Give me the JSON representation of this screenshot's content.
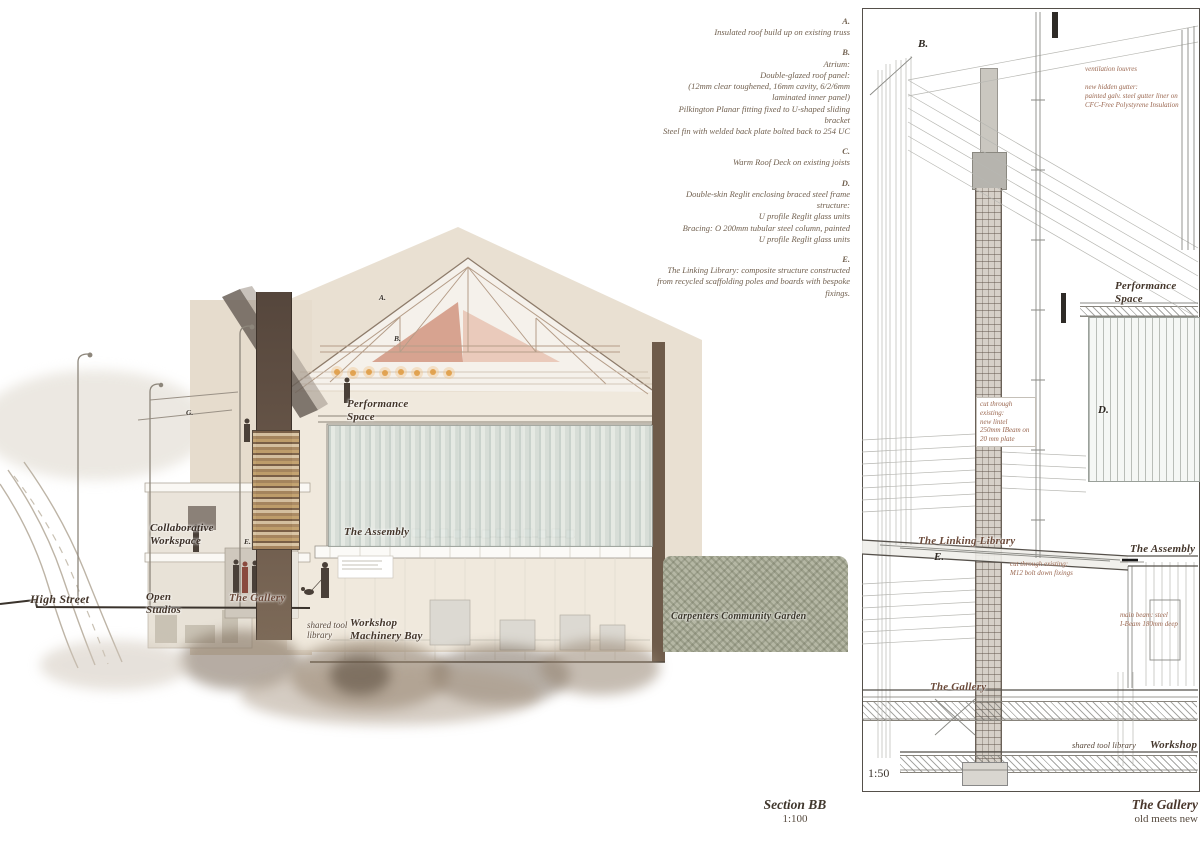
{
  "notes_panel": {
    "items": [
      {
        "letter": "A.",
        "text": "Insulated roof build up on existing truss"
      },
      {
        "letter": "B.",
        "text": "Atrium:\nDouble-glazed roof panel:\n(12mm clear toughened, 16mm cavity, 6/2/6mm\nlaminated inner panel)\nPilkington Planar fitting fixed to U-shaped sliding\nbracket\nSteel fin with welded back plate bolted back to 254 UC"
      },
      {
        "letter": "C.",
        "text": "Warm Roof Deck on existing joists"
      },
      {
        "letter": "D.",
        "text": "Double-skin Reglit enclosing braced steel frame\nstructure:\nU profile Reglit glass units\nBracing: O 200mm tubular steel column, painted\nU profile Reglit glass units"
      },
      {
        "letter": "E.",
        "text": "The Linking Library: composite structure constructed\nfrom recycled scaffolding poles and boards with bespoke\nfixings."
      }
    ]
  },
  "section_drawing": {
    "labels": {
      "high_street": "High Street",
      "open_studios": "Open\nStudios",
      "collaborative_workspace": "Collaborative\nWorkspace",
      "the_gallery": "The Gallery",
      "performance_space": "Performance\nSpace",
      "the_assembly": "The Assembly",
      "shared_tool_library": "shared tool\nlibrary",
      "workshop_machinery_bay": "Workshop\nMachinery Bay",
      "carpenters_garden": "Carpenters Community Garden"
    },
    "markers": {
      "a": "A.",
      "b": "B.",
      "e": "E.",
      "g": "G."
    },
    "caption_title": "Section BB",
    "caption_scale": "1:100"
  },
  "detail_drawing": {
    "labels": {
      "marker_b": "B.",
      "performance_space": "Performance\nSpace",
      "marker_d": "D.",
      "linking_library": "The Linking Library",
      "marker_e": "E.",
      "the_assembly": "The Assembly",
      "the_gallery": "The Gallery",
      "shared_tool_library": "shared tool library",
      "workshop": "Workshop",
      "scale": "1:50"
    },
    "notes": {
      "ventilation": "ventilation louvres",
      "gutter": "new hidden gutter:\npainted galv. steel gutter liner on\nCFC-Free Polystyrene Insulation",
      "lintel": "cut through\nexisting:\nnew lintel\n250mm IBeam on\n20 mm plate",
      "bolt": "cut through existing:\nM12 bolt down fixings",
      "beam": "main beam: steel\nI-Beam 180mm deep"
    },
    "caption_title": "The Gallery",
    "caption_subtitle": "old meets new"
  },
  "colors": {
    "label_brown": "#43352a",
    "warm_brown": "#6b4a3a",
    "note_red": "#9a6750",
    "annotation_sepia": "#71604f",
    "wash_beige": "#e9e0d2",
    "roof_pink": "#d49a86",
    "glazing_green": "#c3cfca",
    "hedge_green": "#b5b7a4",
    "smoke_brown": "#8c7a68"
  }
}
